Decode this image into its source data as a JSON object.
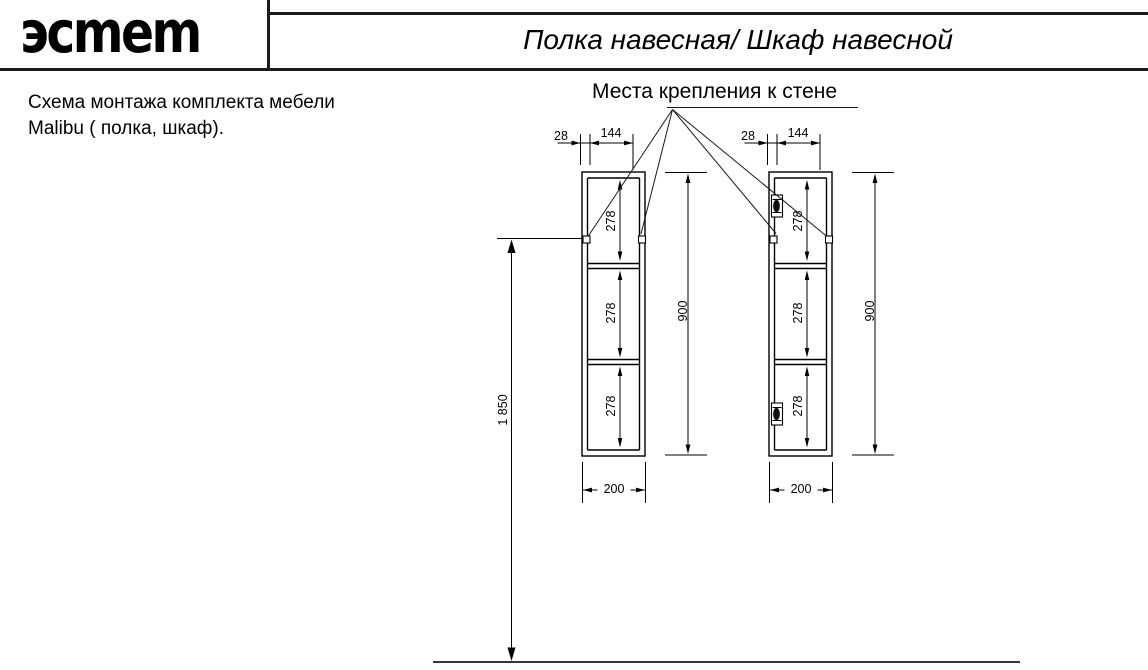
{
  "header": {
    "logo_text": "эсmem",
    "title": "Полка навесная/ Шкаф навесной"
  },
  "note": {
    "line1": "Схема монтажа комплекта мебели",
    "line2": "Malibu ( полка, шкаф)."
  },
  "callout": {
    "label": "Места крепления к стене"
  },
  "dims": {
    "side_offset": "28",
    "hole_spacing": "144",
    "section_height": "278",
    "cabinet_height": "900",
    "cabinet_width": "200",
    "mounting_height": "1 850"
  },
  "colors": {
    "line": "#000000",
    "paper": "#ffffff"
  }
}
